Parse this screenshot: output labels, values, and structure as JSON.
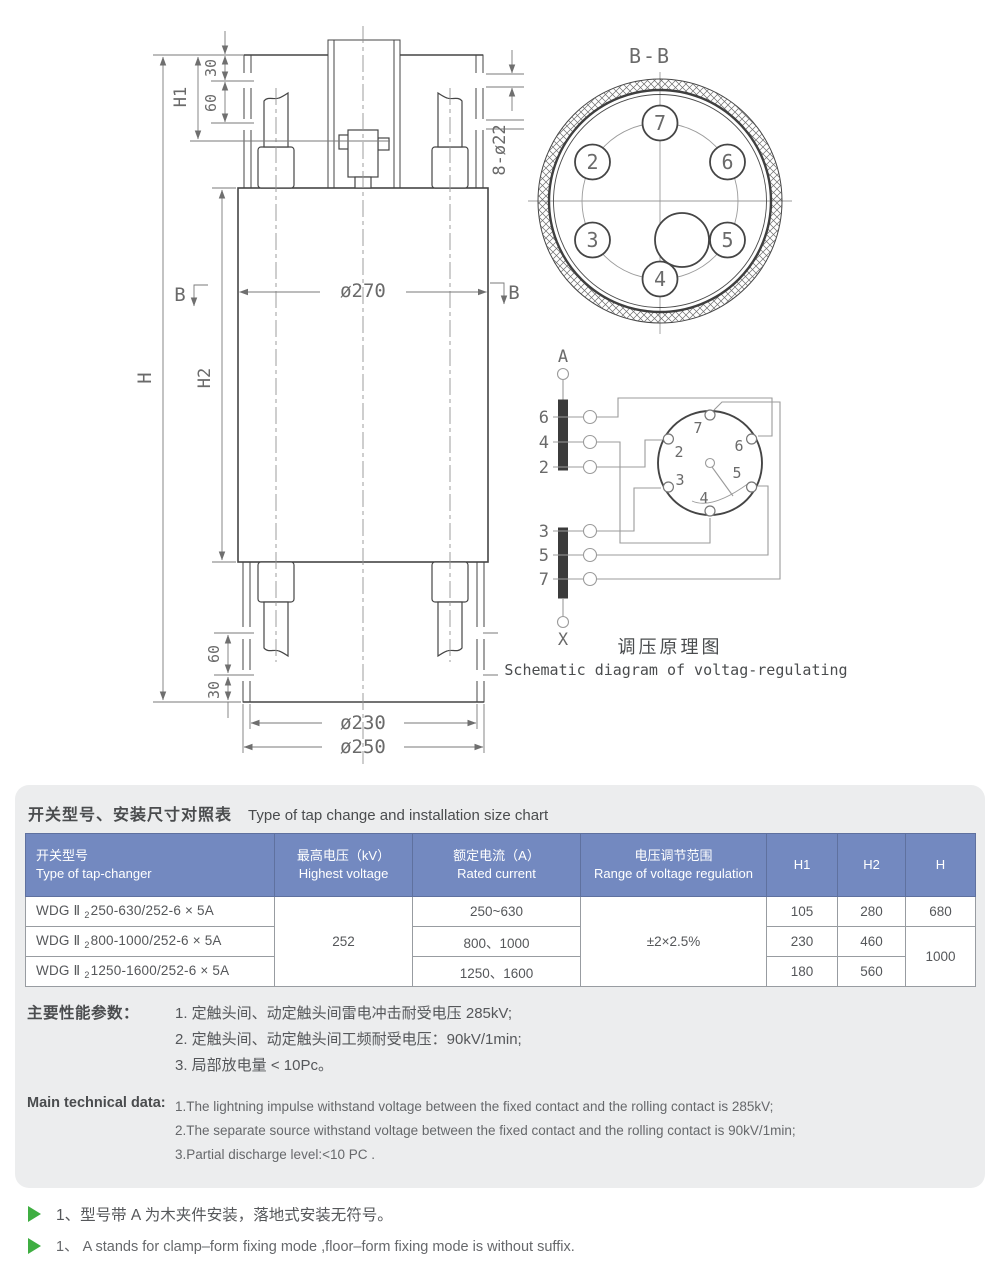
{
  "colors": {
    "header_blue": "#7389c0",
    "header_border": "#5f719f",
    "panel_bg": "#ecedee",
    "note_green": "#3fae42",
    "outline_gray": "#454545",
    "dim_gray": "#7a7a7a"
  },
  "drawing": {
    "front": {
      "h": "H",
      "h1": "H1",
      "h2": "H2",
      "top_30": "30",
      "top_60": "60",
      "bottom_60": "60",
      "bottom_30": "30",
      "dia_270": "ø270",
      "dia_230": "ø230",
      "dia_250": "ø250",
      "holes": "8-ø22",
      "section_left": "B",
      "section_right": "B"
    },
    "section_bb": {
      "title": "B-B",
      "contacts": [
        "7",
        "2",
        "6",
        "3",
        "5",
        "4"
      ]
    },
    "schematic": {
      "terminal_top": "A",
      "terminal_bottom": "X",
      "upper_taps": [
        "6",
        "4",
        "2"
      ],
      "lower_taps": [
        "3",
        "5",
        "7"
      ],
      "selector": [
        "7",
        "2",
        "6",
        "3",
        "5",
        "4"
      ],
      "caption_zh": "调压原理图",
      "caption_en": "Schematic diagram of voltag-regulating"
    }
  },
  "panel": {
    "title_zh": "开关型号、安装尺寸对照表",
    "title_en": "Type of tap change and installation size chart",
    "table": {
      "headers": [
        {
          "zh": "开关型号",
          "en": "Type of tap-changer"
        },
        {
          "zh": "最高电压（kV）",
          "en": "Highest voltage"
        },
        {
          "zh": "额定电流（A）",
          "en": "Rated current"
        },
        {
          "zh": "电压调节范围",
          "en": "Range of voltage regulation"
        },
        {
          "en": "H1"
        },
        {
          "en": "H2"
        },
        {
          "en": "H"
        }
      ],
      "shared": {
        "voltage": "252",
        "range": "±2×2.5%",
        "h_rows23": "1000"
      },
      "rows": [
        {
          "model_prefix": "WDG Ⅱ",
          "model_sub": "2",
          "model_rest": "250-630/252-6 × 5A",
          "current": "250~630",
          "h1": "105",
          "h2": "280",
          "h": "680"
        },
        {
          "model_prefix": "WDG Ⅱ",
          "model_sub": "2",
          "model_rest": "800-1000/252-6 × 5A",
          "current": "800、1000",
          "h1": "230",
          "h2": "460"
        },
        {
          "model_prefix": "WDG Ⅱ",
          "model_sub": "2",
          "model_rest": "1250-1600/252-6 × 5A",
          "current": "1250、1600",
          "h1": "180",
          "h2": "560"
        }
      ]
    },
    "performance": {
      "label": "主要性能参数：",
      "items": [
        "1. 定触头间、动定触头间雷电冲击耐受电压 285kV;",
        "2. 定触头间、动定触头间工频耐受电压：90kV/1min;",
        "3. 局部放电量 < 10Pc。"
      ]
    },
    "technical": {
      "label": "Main technical data:",
      "items": [
        "1.The lightning impulse withstand voltage between the fixed contact and the rolling contact is 285kV;",
        "2.The separate source withstand voltage between the fixed contact and the rolling contact is 90kV/1min;",
        "3.Partial discharge level:<10 PC ."
      ]
    }
  },
  "notes": [
    "1、型号带 A 为木夹件安装，落地式安装无符号。",
    "1、 A stands for clamp–form fixing mode ,floor–form fixing mode is without suffix."
  ]
}
